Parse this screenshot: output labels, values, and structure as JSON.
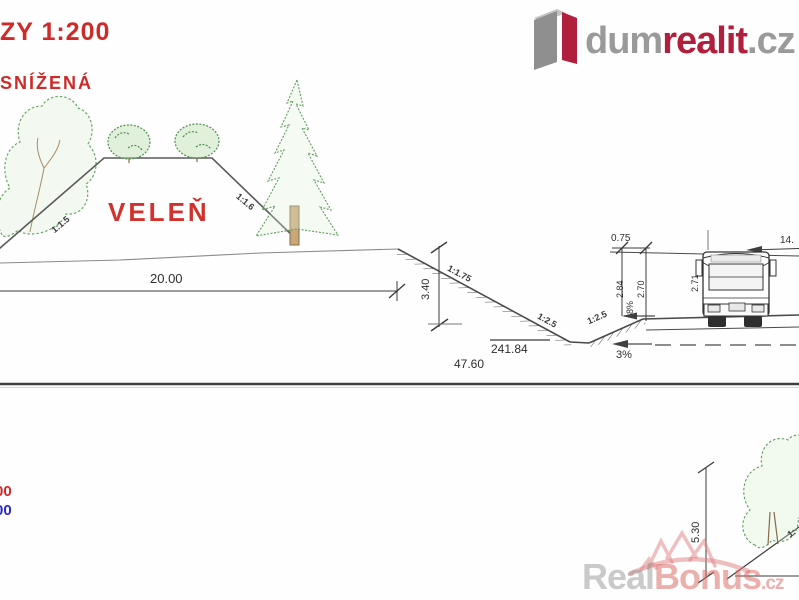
{
  "header": {
    "scale_label": "ZY 1:200",
    "variant_label": "SNÍŽENÁ"
  },
  "brand": {
    "word_gray": "dum",
    "word_red": "realit",
    "tld": ".cz"
  },
  "cross_section": {
    "place_label": "VELEŇ",
    "mound_slope_left": "1:1.5",
    "mound_slope_right": "1:1.6",
    "mound_width": "20.00",
    "ditch_depth": "3.40",
    "ditch_slope_main": "1:1.75",
    "ditch_slope_left": "1:2.5",
    "ditch_slope_right": "1:2.5",
    "bottom_level": "241.84",
    "total_width": "47.60",
    "road_grade": "3%",
    "verge_width": "0.75",
    "edge_height_left": "2.84",
    "edge_height_right": "2.70",
    "verge_grade": "8%",
    "vehicle_height": "2.71",
    "right_dim_partial": "14."
  },
  "lower_section": {
    "height_dim": "5.30",
    "slope_label_partial": "1:",
    "elevation_red_partial": "00",
    "elevation_blue_partial": "00"
  },
  "watermark": {
    "word_gray": "Real",
    "word_red": "Bonus",
    "tld": ".cz"
  },
  "colors": {
    "cad_red": "#cd2a28",
    "cad_blue": "#2b2bc4",
    "brand_red": "#b01f3c",
    "brand_gray": "#9a9a9a",
    "line_dark": "#3f3f3f",
    "tree_green": "#63a05e",
    "watermark_pink": "#e07f7f"
  }
}
